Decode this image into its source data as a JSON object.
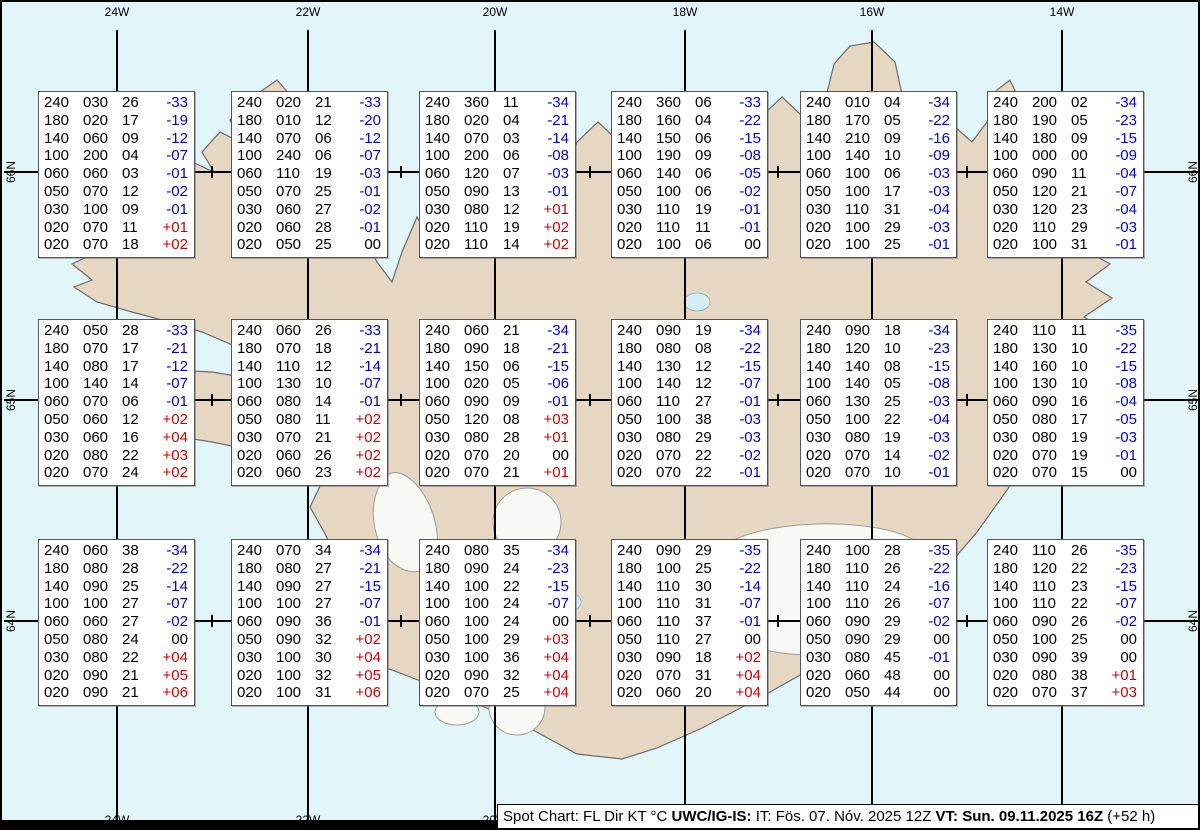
{
  "caption": {
    "lead": "Spot Chart: FL Dir KT °C ",
    "source": "UWC/IG-IS:",
    "issue": " IT: Fös. 07. Nóv. 2025 12Z ",
    "valid": "VT: Sun. 09.11.2025 16Z",
    "tail": " (+52 h)"
  },
  "grid": {
    "meridians": [
      {
        "x": 115,
        "label": "24W"
      },
      {
        "x": 306,
        "label": "22W"
      },
      {
        "x": 493,
        "label": "20W"
      },
      {
        "x": 683,
        "label": "18W"
      },
      {
        "x": 870,
        "label": "16W"
      },
      {
        "x": 1060,
        "label": "14W"
      }
    ],
    "bottom_labels": [
      "24W",
      "22W",
      "20W"
    ],
    "parallels": [
      {
        "y": 170,
        "label": "66N"
      },
      {
        "y": 398,
        "label": "65N"
      },
      {
        "y": 619,
        "label": "64N"
      }
    ],
    "tick_xs": [
      210,
      399,
      588,
      776,
      965
    ]
  },
  "layout": {
    "box_x": [
      36,
      229,
      417,
      609,
      798,
      985
    ],
    "box_y": [
      89,
      317,
      537
    ],
    "grid_top": 28,
    "grid_bottom": 822,
    "top_label_y": 3,
    "bottom_label_y": 811,
    "left_label_x": 9,
    "right_label_x": 1191
  },
  "colors": {
    "negative_temp": "#0000d0",
    "positive_temp": "#d00000",
    "land": "#e6d7c3",
    "ocean": "#e2f5f9"
  },
  "columns": [
    "FL",
    "Dir",
    "KT",
    "°C"
  ],
  "spots": [
    {
      "row": 0,
      "col": 0,
      "rows": [
        [
          "240",
          "030",
          "26",
          "-33"
        ],
        [
          "180",
          "020",
          "17",
          "-19"
        ],
        [
          "140",
          "060",
          "09",
          "-12"
        ],
        [
          "100",
          "200",
          "04",
          "-07"
        ],
        [
          "060",
          "060",
          "03",
          "-01"
        ],
        [
          "050",
          "070",
          "12",
          "-02"
        ],
        [
          "030",
          "100",
          "09",
          "-01"
        ],
        [
          "020",
          "070",
          "11",
          "+01"
        ],
        [
          "020",
          "070",
          "18",
          "+02"
        ]
      ]
    },
    {
      "row": 0,
      "col": 1,
      "rows": [
        [
          "240",
          "020",
          "21",
          "-33"
        ],
        [
          "180",
          "010",
          "12",
          "-20"
        ],
        [
          "140",
          "070",
          "06",
          "-12"
        ],
        [
          "100",
          "240",
          "06",
          "-07"
        ],
        [
          "060",
          "110",
          "19",
          "-03"
        ],
        [
          "050",
          "070",
          "25",
          "-01"
        ],
        [
          "030",
          "060",
          "27",
          "-02"
        ],
        [
          "020",
          "060",
          "28",
          "-01"
        ],
        [
          "020",
          "050",
          "25",
          "00"
        ]
      ]
    },
    {
      "row": 0,
      "col": 2,
      "rows": [
        [
          "240",
          "360",
          "11",
          "-34"
        ],
        [
          "180",
          "020",
          "04",
          "-21"
        ],
        [
          "140",
          "070",
          "03",
          "-14"
        ],
        [
          "100",
          "200",
          "06",
          "-08"
        ],
        [
          "060",
          "120",
          "07",
          "-03"
        ],
        [
          "050",
          "090",
          "13",
          "-01"
        ],
        [
          "030",
          "080",
          "12",
          "+01"
        ],
        [
          "020",
          "110",
          "19",
          "+02"
        ],
        [
          "020",
          "110",
          "14",
          "+02"
        ]
      ]
    },
    {
      "row": 0,
      "col": 3,
      "rows": [
        [
          "240",
          "360",
          "06",
          "-33"
        ],
        [
          "180",
          "160",
          "04",
          "-22"
        ],
        [
          "140",
          "150",
          "06",
          "-15"
        ],
        [
          "100",
          "190",
          "09",
          "-08"
        ],
        [
          "060",
          "140",
          "06",
          "-05"
        ],
        [
          "050",
          "100",
          "06",
          "-02"
        ],
        [
          "030",
          "110",
          "19",
          "-01"
        ],
        [
          "020",
          "110",
          "11",
          "-01"
        ],
        [
          "020",
          "100",
          "06",
          "00"
        ]
      ]
    },
    {
      "row": 0,
      "col": 4,
      "rows": [
        [
          "240",
          "010",
          "04",
          "-34"
        ],
        [
          "180",
          "170",
          "05",
          "-22"
        ],
        [
          "140",
          "210",
          "09",
          "-16"
        ],
        [
          "100",
          "140",
          "10",
          "-09"
        ],
        [
          "060",
          "100",
          "06",
          "-03"
        ],
        [
          "050",
          "100",
          "17",
          "-03"
        ],
        [
          "030",
          "110",
          "31",
          "-04"
        ],
        [
          "020",
          "100",
          "29",
          "-03"
        ],
        [
          "020",
          "100",
          "25",
          "-01"
        ]
      ]
    },
    {
      "row": 0,
      "col": 5,
      "rows": [
        [
          "240",
          "200",
          "02",
          "-34"
        ],
        [
          "180",
          "190",
          "05",
          "-23"
        ],
        [
          "140",
          "180",
          "09",
          "-15"
        ],
        [
          "100",
          "000",
          "00",
          "-09"
        ],
        [
          "060",
          "090",
          "11",
          "-04"
        ],
        [
          "050",
          "120",
          "21",
          "-07"
        ],
        [
          "030",
          "120",
          "23",
          "-04"
        ],
        [
          "020",
          "110",
          "29",
          "-03"
        ],
        [
          "020",
          "100",
          "31",
          "-01"
        ]
      ]
    },
    {
      "row": 1,
      "col": 0,
      "rows": [
        [
          "240",
          "050",
          "28",
          "-33"
        ],
        [
          "180",
          "070",
          "17",
          "-21"
        ],
        [
          "140",
          "080",
          "17",
          "-12"
        ],
        [
          "100",
          "140",
          "14",
          "-07"
        ],
        [
          "060",
          "070",
          "06",
          "-01"
        ],
        [
          "050",
          "060",
          "12",
          "+02"
        ],
        [
          "030",
          "060",
          "16",
          "+04"
        ],
        [
          "020",
          "080",
          "22",
          "+03"
        ],
        [
          "020",
          "070",
          "24",
          "+02"
        ]
      ]
    },
    {
      "row": 1,
      "col": 1,
      "rows": [
        [
          "240",
          "060",
          "26",
          "-33"
        ],
        [
          "180",
          "070",
          "18",
          "-21"
        ],
        [
          "140",
          "110",
          "12",
          "-14"
        ],
        [
          "100",
          "130",
          "10",
          "-07"
        ],
        [
          "060",
          "080",
          "14",
          "-01"
        ],
        [
          "050",
          "080",
          "11",
          "+02"
        ],
        [
          "030",
          "070",
          "21",
          "+02"
        ],
        [
          "020",
          "060",
          "26",
          "+02"
        ],
        [
          "020",
          "060",
          "23",
          "+02"
        ]
      ]
    },
    {
      "row": 1,
      "col": 2,
      "rows": [
        [
          "240",
          "060",
          "21",
          "-34"
        ],
        [
          "180",
          "090",
          "18",
          "-21"
        ],
        [
          "140",
          "150",
          "06",
          "-15"
        ],
        [
          "100",
          "020",
          "05",
          "-06"
        ],
        [
          "060",
          "090",
          "09",
          "-01"
        ],
        [
          "050",
          "120",
          "08",
          "+03"
        ],
        [
          "030",
          "080",
          "28",
          "+01"
        ],
        [
          "020",
          "070",
          "20",
          "00"
        ],
        [
          "020",
          "070",
          "21",
          "+01"
        ]
      ]
    },
    {
      "row": 1,
      "col": 3,
      "rows": [
        [
          "240",
          "090",
          "19",
          "-34"
        ],
        [
          "180",
          "080",
          "08",
          "-22"
        ],
        [
          "140",
          "130",
          "12",
          "-15"
        ],
        [
          "100",
          "140",
          "12",
          "-07"
        ],
        [
          "060",
          "110",
          "27",
          "-01"
        ],
        [
          "050",
          "100",
          "38",
          "-03"
        ],
        [
          "030",
          "080",
          "29",
          "-03"
        ],
        [
          "020",
          "070",
          "22",
          "-02"
        ],
        [
          "020",
          "070",
          "22",
          "-01"
        ]
      ]
    },
    {
      "row": 1,
      "col": 4,
      "rows": [
        [
          "240",
          "090",
          "18",
          "-34"
        ],
        [
          "180",
          "120",
          "10",
          "-23"
        ],
        [
          "140",
          "140",
          "08",
          "-15"
        ],
        [
          "100",
          "140",
          "05",
          "-08"
        ],
        [
          "060",
          "130",
          "25",
          "-03"
        ],
        [
          "050",
          "100",
          "22",
          "-04"
        ],
        [
          "030",
          "080",
          "19",
          "-03"
        ],
        [
          "020",
          "070",
          "14",
          "-02"
        ],
        [
          "020",
          "070",
          "10",
          "-01"
        ]
      ]
    },
    {
      "row": 1,
      "col": 5,
      "rows": [
        [
          "240",
          "110",
          "11",
          "-35"
        ],
        [
          "180",
          "130",
          "10",
          "-22"
        ],
        [
          "140",
          "160",
          "10",
          "-15"
        ],
        [
          "100",
          "130",
          "10",
          "-08"
        ],
        [
          "060",
          "090",
          "16",
          "-04"
        ],
        [
          "050",
          "080",
          "17",
          "-05"
        ],
        [
          "030",
          "080",
          "19",
          "-03"
        ],
        [
          "020",
          "070",
          "19",
          "-01"
        ],
        [
          "020",
          "070",
          "15",
          "00"
        ]
      ]
    },
    {
      "row": 2,
      "col": 0,
      "rows": [
        [
          "240",
          "060",
          "38",
          "-34"
        ],
        [
          "180",
          "080",
          "28",
          "-22"
        ],
        [
          "140",
          "090",
          "25",
          "-14"
        ],
        [
          "100",
          "100",
          "27",
          "-07"
        ],
        [
          "060",
          "060",
          "27",
          "-02"
        ],
        [
          "050",
          "080",
          "24",
          "00"
        ],
        [
          "030",
          "080",
          "22",
          "+04"
        ],
        [
          "020",
          "090",
          "21",
          "+05"
        ],
        [
          "020",
          "090",
          "21",
          "+06"
        ]
      ]
    },
    {
      "row": 2,
      "col": 1,
      "rows": [
        [
          "240",
          "070",
          "34",
          "-34"
        ],
        [
          "180",
          "080",
          "27",
          "-21"
        ],
        [
          "140",
          "090",
          "27",
          "-15"
        ],
        [
          "100",
          "100",
          "27",
          "-07"
        ],
        [
          "060",
          "090",
          "36",
          "-01"
        ],
        [
          "050",
          "090",
          "32",
          "+02"
        ],
        [
          "030",
          "100",
          "30",
          "+04"
        ],
        [
          "020",
          "100",
          "32",
          "+05"
        ],
        [
          "020",
          "100",
          "31",
          "+06"
        ]
      ]
    },
    {
      "row": 2,
      "col": 2,
      "rows": [
        [
          "240",
          "080",
          "35",
          "-34"
        ],
        [
          "180",
          "090",
          "24",
          "-23"
        ],
        [
          "140",
          "100",
          "22",
          "-15"
        ],
        [
          "100",
          "100",
          "24",
          "-07"
        ],
        [
          "060",
          "100",
          "24",
          "00"
        ],
        [
          "050",
          "100",
          "29",
          "+03"
        ],
        [
          "030",
          "100",
          "36",
          "+04"
        ],
        [
          "020",
          "090",
          "32",
          "+04"
        ],
        [
          "020",
          "070",
          "25",
          "+04"
        ]
      ]
    },
    {
      "row": 2,
      "col": 3,
      "rows": [
        [
          "240",
          "090",
          "29",
          "-35"
        ],
        [
          "180",
          "100",
          "25",
          "-22"
        ],
        [
          "140",
          "110",
          "30",
          "-14"
        ],
        [
          "100",
          "110",
          "31",
          "-07"
        ],
        [
          "060",
          "110",
          "37",
          "-01"
        ],
        [
          "050",
          "110",
          "27",
          "00"
        ],
        [
          "030",
          "090",
          "18",
          "+02"
        ],
        [
          "020",
          "070",
          "31",
          "+04"
        ],
        [
          "020",
          "060",
          "20",
          "+04"
        ]
      ]
    },
    {
      "row": 2,
      "col": 4,
      "rows": [
        [
          "240",
          "100",
          "28",
          "-35"
        ],
        [
          "180",
          "110",
          "26",
          "-22"
        ],
        [
          "140",
          "110",
          "24",
          "-16"
        ],
        [
          "100",
          "110",
          "26",
          "-07"
        ],
        [
          "060",
          "090",
          "29",
          "-02"
        ],
        [
          "050",
          "090",
          "29",
          "00"
        ],
        [
          "030",
          "080",
          "45",
          "-01"
        ],
        [
          "020",
          "060",
          "48",
          "00"
        ],
        [
          "020",
          "050",
          "44",
          "00"
        ]
      ]
    },
    {
      "row": 2,
      "col": 5,
      "rows": [
        [
          "240",
          "110",
          "26",
          "-35"
        ],
        [
          "180",
          "120",
          "22",
          "-23"
        ],
        [
          "140",
          "110",
          "23",
          "-15"
        ],
        [
          "100",
          "110",
          "22",
          "-07"
        ],
        [
          "060",
          "090",
          "26",
          "-02"
        ],
        [
          "050",
          "100",
          "25",
          "00"
        ],
        [
          "030",
          "090",
          "39",
          "00"
        ],
        [
          "020",
          "080",
          "38",
          "+01"
        ],
        [
          "020",
          "070",
          "37",
          "+03"
        ]
      ]
    }
  ]
}
